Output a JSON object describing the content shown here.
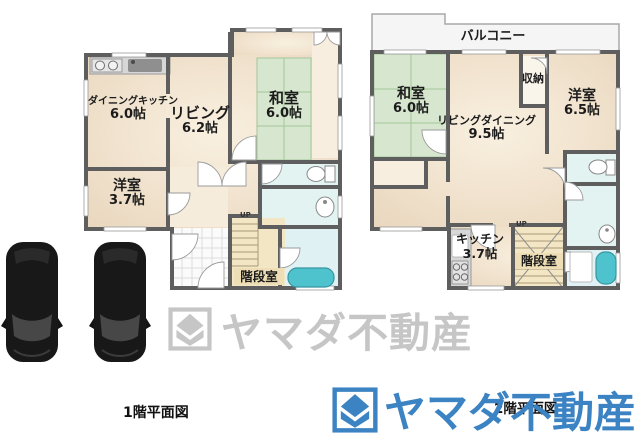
{
  "floor1": {
    "caption": "1階平面図",
    "up_label": "UP",
    "stair_label": "階段室",
    "rooms": {
      "dining_kitchen": {
        "name": "ダイニングキッチン",
        "size": "6.0帖"
      },
      "living": {
        "name": "リビング",
        "size": "6.2帖"
      },
      "japanese_room": {
        "name": "和室",
        "size": "6.0帖"
      },
      "western_room": {
        "name": "洋室",
        "size": "3.7帖"
      }
    }
  },
  "floor2": {
    "caption": "2階平面図",
    "up_label": "UP",
    "stair_label": "階段室",
    "rooms": {
      "balcony": {
        "name": "バルコニー"
      },
      "japanese_room": {
        "name": "和室",
        "size": "6.0帖"
      },
      "living_dining": {
        "name": "リビングダイニング",
        "size": "9.5帖"
      },
      "storage": {
        "name": "収納"
      },
      "western_room": {
        "name": "洋室",
        "size": "6.5帖"
      },
      "kitchen": {
        "name": "キッチン",
        "size": "3.7帖"
      }
    }
  },
  "watermark": {
    "text": "ヤマダ不動産",
    "color": "#c6c6c6"
  },
  "brand": {
    "text": "ヤマダ不動産",
    "color": "#3c83c4"
  },
  "colors": {
    "wall": "#5e5e5e",
    "floor": "#f1e2cf",
    "tatami": "#d7e7cf",
    "bath_floor": "#e2f3f2",
    "bathtub": "#4fc3cd",
    "stairs": "#f3e6c4",
    "balcony": "#f5f5f5"
  }
}
